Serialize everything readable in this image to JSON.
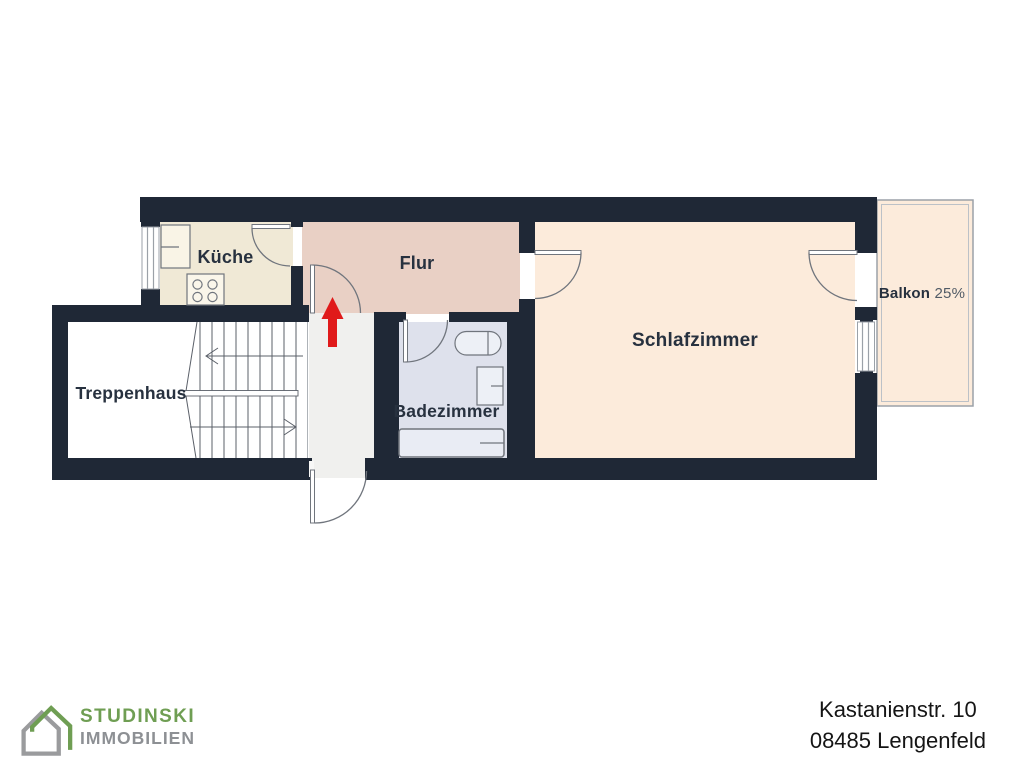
{
  "branding": {
    "name_line1": "STUDINSKI",
    "name_line2": "IMMOBILIEN"
  },
  "address": {
    "line1": "Kastanienstr. 10",
    "line2": "08485 Lengenfeld"
  },
  "rooms": {
    "kueche": {
      "label": "Küche"
    },
    "flur": {
      "label": "Flur"
    },
    "schlafzimmer": {
      "label": "Schlafzimmer"
    },
    "badezimmer": {
      "label": "Badezimmer"
    },
    "treppenhaus": {
      "label": "Treppenhaus"
    },
    "balkon": {
      "label": "Balkon",
      "share": "25%"
    }
  },
  "icons": {
    "entrance_arrow": "red-up-arrow",
    "logo": "double-house-outline",
    "stair_direction": "up"
  },
  "colors": {
    "wall": "#1f2836",
    "kueche_floor": "#f0e9d6",
    "flur_floor": "#e9d0c5",
    "schlafzimmer_floor": "#fcebdb",
    "badezimmer_floor": "#dee1ec",
    "treppenhaus_floor": "#ffffff",
    "landing_floor": "#f0f0ee",
    "balkon_floor": "#fcebdb",
    "entrance_arrow": "#e01a1a",
    "logo_green": "#6f9e53",
    "logo_gray": "#8d9094",
    "label_text": "#27313f"
  }
}
